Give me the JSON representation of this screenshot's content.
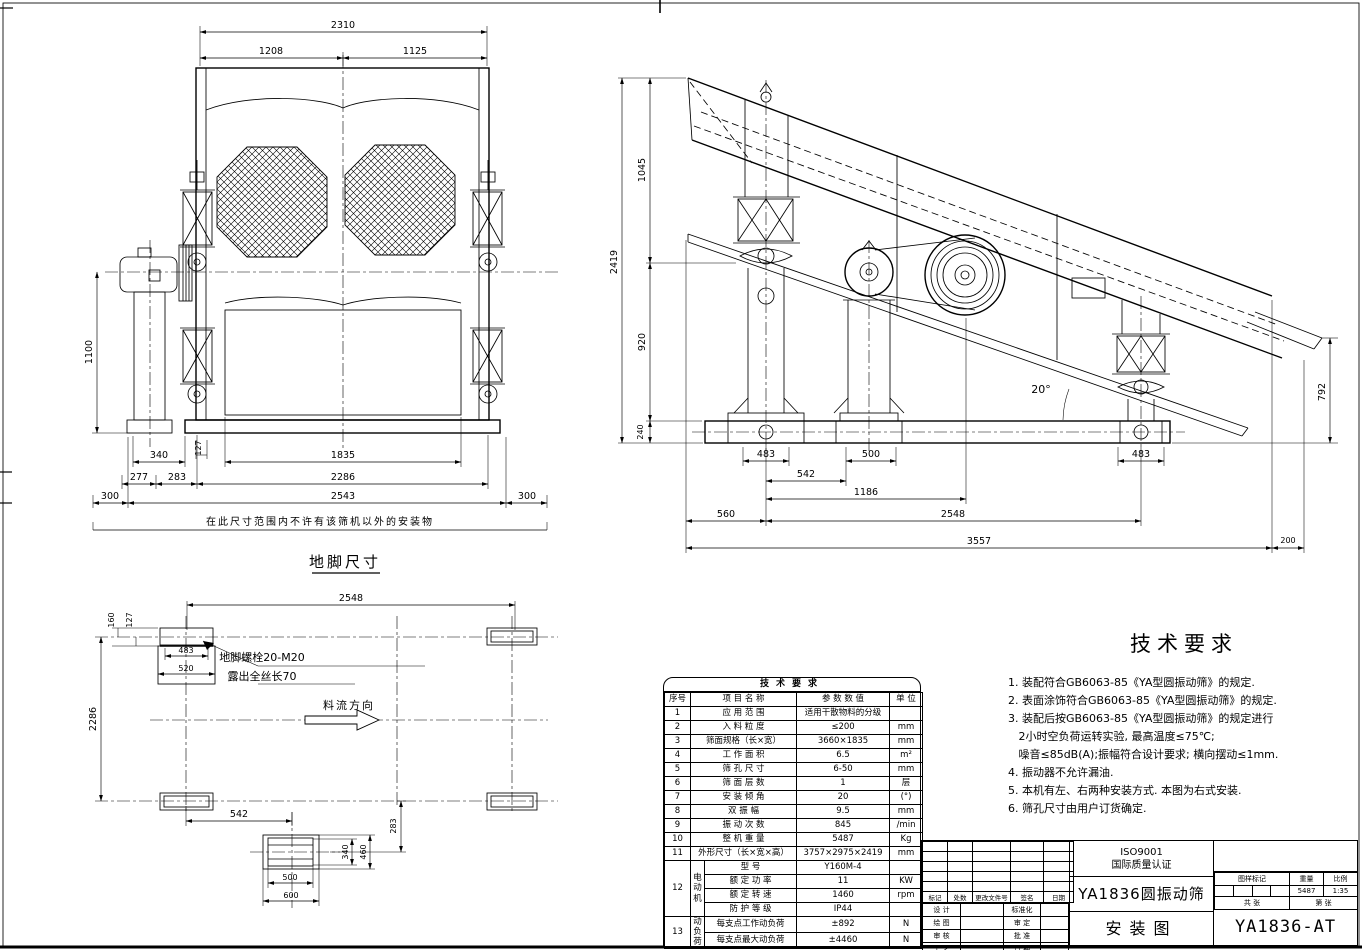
{
  "front_view": {
    "caption": "地脚尺寸",
    "note": "在此尺寸范围内不许有该筛机以外的安装物",
    "dims": {
      "total_width": "2310",
      "left_width": "1208",
      "right_width": "1125",
      "height": "1100",
      "pedestal": "340",
      "offset_a": "277",
      "offset_b": "283",
      "gap": "127",
      "inner_width": "1835",
      "bolt_span": "2286",
      "base_width": "2543",
      "margin_left": "300",
      "margin_right": "300"
    }
  },
  "side_view": {
    "dims": {
      "upper_height": "1045",
      "total_height": "2419",
      "mid_height": "920",
      "base_height": "240",
      "bolt_l": "483",
      "bolt_c": "500",
      "bolt_r": "483",
      "leg_gap": "542",
      "drive_span": "1186",
      "front_offset": "560",
      "support_span": "2548",
      "total_length": "3557",
      "rear_offset": "200",
      "discharge_height": "792",
      "incline_angle": "20°"
    }
  },
  "plan_view": {
    "bolt_note_line1": "地脚螺栓20-M20",
    "bolt_note_line2": "露出全丝长70",
    "flow_label": "料流方向",
    "dims": {
      "support_span": "2548",
      "edge_a": "160",
      "edge_b": "127",
      "pad_inner": "483",
      "pad_outer": "520",
      "bolt_span": "2286",
      "leg_gap": "542",
      "offset": "283",
      "pad_h_inner": "340",
      "pad_h_outer": "460",
      "pad_w_inner": "500",
      "pad_w_outer": "600"
    }
  },
  "param_table": {
    "title": "技术要求",
    "headers": [
      "序号",
      "项 目 名 称",
      "参 数 数 值",
      "单 位"
    ],
    "rows": [
      [
        "1",
        "应 用 范 围",
        "适用干散物料的分级",
        ""
      ],
      [
        "2",
        "入 料 粒 度",
        "≤200",
        "mm"
      ],
      [
        "3",
        "筛面规格（长×宽）",
        "3660×1835",
        "mm"
      ],
      [
        "4",
        "工 作 面 积",
        "6.5",
        "m²"
      ],
      [
        "5",
        "筛 孔 尺 寸",
        "6-50",
        "mm"
      ],
      [
        "6",
        "筛 面 层 数",
        "1",
        "层"
      ],
      [
        "7",
        "安 装 倾 角",
        "20",
        "(°)"
      ],
      [
        "8",
        "双 振 幅",
        "9.5",
        "mm"
      ],
      [
        "9",
        "振 动 次 数",
        "845",
        "/min"
      ],
      [
        "10",
        "整 机 重 量",
        "5487",
        "Kg"
      ],
      [
        "11",
        "外形尺寸（长×宽×高）",
        "3757×2975×2419",
        "mm"
      ]
    ],
    "group12": {
      "no": "12",
      "group": "电动机",
      "items": [
        [
          "型  号",
          "Y160M-4",
          ""
        ],
        [
          "额 定 功 率",
          "11",
          "KW"
        ],
        [
          "额 定 转 速",
          "1460",
          "rpm"
        ],
        [
          "防 护 等 级",
          "IP44",
          ""
        ]
      ]
    },
    "group13": {
      "no": "13",
      "group": "动负荷",
      "items": [
        [
          "每支点工作动负荷",
          "±892",
          "N"
        ],
        [
          "每支点最大动负荷",
          "±4460",
          "N"
        ]
      ]
    }
  },
  "tech_req": {
    "title": "技术要求",
    "lines": [
      "1. 装配符合GB6063-85《YA型圆振动筛》的规定.",
      "2. 表面涂饰符合GB6063-85《YA型圆振动筛》的规定.",
      "3. 装配后按GB6063-85《YA型圆振动筛》的规定进行",
      "   2小时空负荷运转实验, 最高温度≤75℃;",
      "   噪音≤85dB(A);振幅符合设计要求; 横向摆动≤1mm.",
      "4. 振动器不允许漏油.",
      "5. 本机有左、右两种安装方式. 本图为右式安装.",
      "6. 筛孔尺寸由用户订货确定."
    ]
  },
  "title_block": {
    "iso_line1": "ISO9001",
    "iso_line2": "国际质量认证",
    "product": "YA1836圆振动筛",
    "doc_type": "安装图",
    "drawing_no": "YA1836-AT",
    "rev_headers": [
      "标记",
      "处数",
      "更改文件号",
      "签名",
      "日期"
    ],
    "sig_rows": [
      [
        "设 计",
        "标准化"
      ],
      [
        "绘 图",
        "审 定"
      ],
      [
        "审 核",
        "批 准"
      ],
      [
        "工 艺",
        "日 期"
      ]
    ],
    "info_headers": [
      "图样标记",
      "重量",
      "比例"
    ],
    "weight_value": "5487",
    "scale_value": "1:35",
    "sheet_total_label": "共  张",
    "sheet_no_label": "第  张"
  }
}
